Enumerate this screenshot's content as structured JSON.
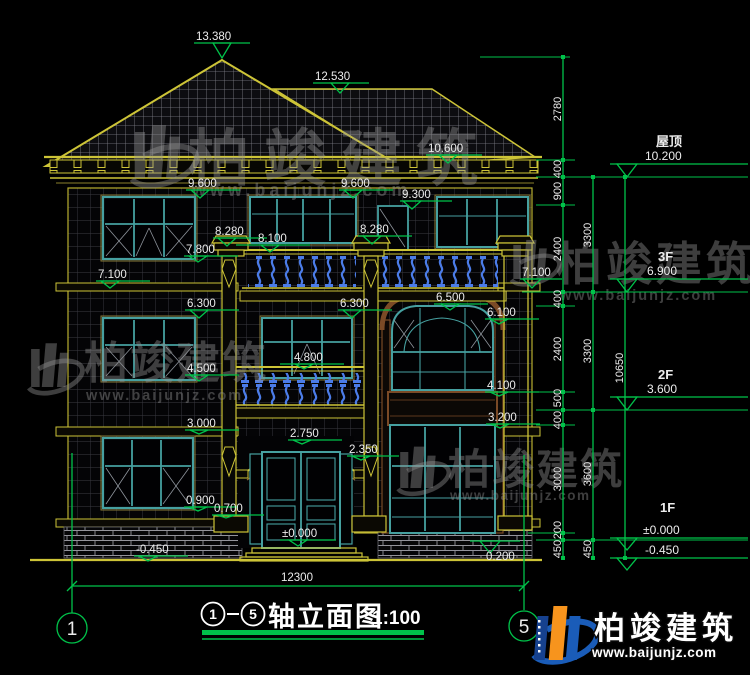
{
  "marks": {
    "peak": "13.380",
    "ridge": "12.530",
    "eave": "10.600",
    "win3f_left": "9.600",
    "win3f_center": "9.600",
    "door3f": "9.300",
    "cap_left": "8.280",
    "cap_right": "8.280",
    "rail3f": "8.100",
    "sill3f": "7.800",
    "band3f_left": "7.100",
    "band3f_right": "7.100",
    "arch_top": "6.500",
    "win2f_left": "6.300",
    "win2f_center": "6.300",
    "win2f_right": "6.100",
    "rail2f": "4.800",
    "sill2f": "4.500",
    "band2f_right": "4.100",
    "spandrel_bottom": "3.200",
    "band2f_left": "3.000",
    "arch1f_apex": "2.750",
    "arch1f_spring": "2.350",
    "sill1f": "0.900",
    "pedestal": "0.700",
    "floor1": "±0.000",
    "ground": "-0.450",
    "base_right": "0.200"
  },
  "right_levels": {
    "roof_label": "屋顶",
    "roof_value": "10.200",
    "f3_label": "3F",
    "f3_value": "6.900",
    "f2_label": "2F",
    "f2_value": "3.600",
    "f1_label": "1F",
    "f1_value": "±0.000",
    "below_ground": "-0.450"
  },
  "dim_chains": {
    "inner": [
      "2780",
      "400",
      "900",
      "2400",
      "400",
      "2400",
      "500",
      "400",
      "3000",
      "200",
      "450"
    ],
    "middle": [
      "3300",
      "3300",
      "3600",
      "450"
    ],
    "outer": [
      "10650"
    ]
  },
  "bottom": {
    "width_dim": "12300",
    "axis_left": "1",
    "axis_right": "5"
  },
  "title": {
    "axis_from": "1",
    "axis_to": "5",
    "text": "轴立面图",
    "scale": "1:100"
  },
  "watermark": {
    "name": "柏竣建筑",
    "url": "www.baijunjz.com"
  },
  "logo": {
    "name": "柏竣建筑",
    "url": "www.baijunjz.com"
  }
}
